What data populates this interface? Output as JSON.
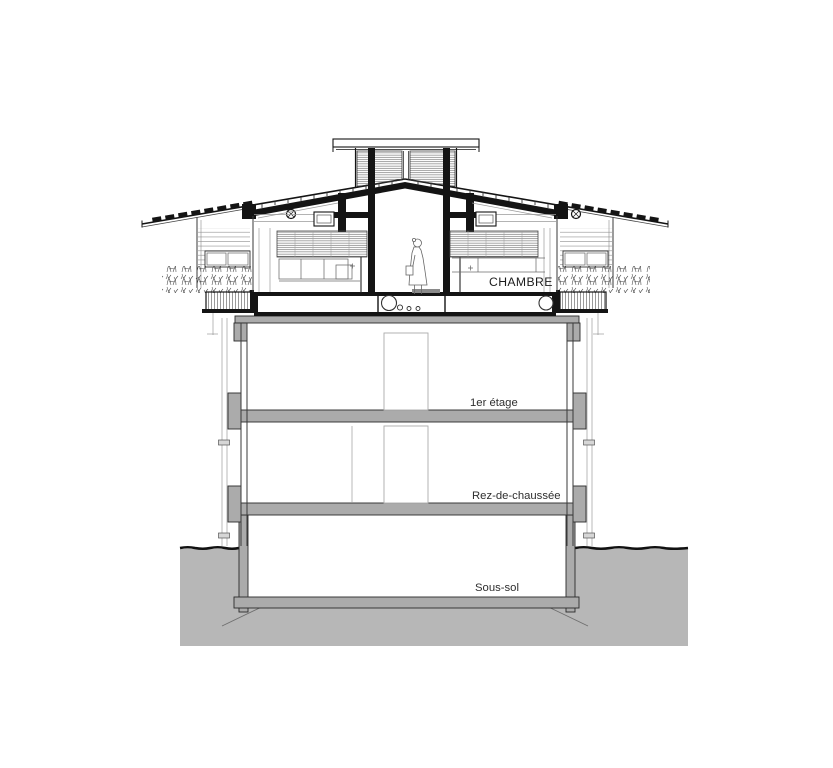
{
  "drawing": {
    "labels": {
      "room": "CHAMBRE",
      "first_floor": "1er étage",
      "ground_floor": "Rez-de-chaussée",
      "basement": "Sous-sol"
    },
    "colors": {
      "line_black": "#141414",
      "structure_grey": "#ababab",
      "terrain_grey": "#b7b7b7",
      "background": "#ffffff"
    }
  }
}
